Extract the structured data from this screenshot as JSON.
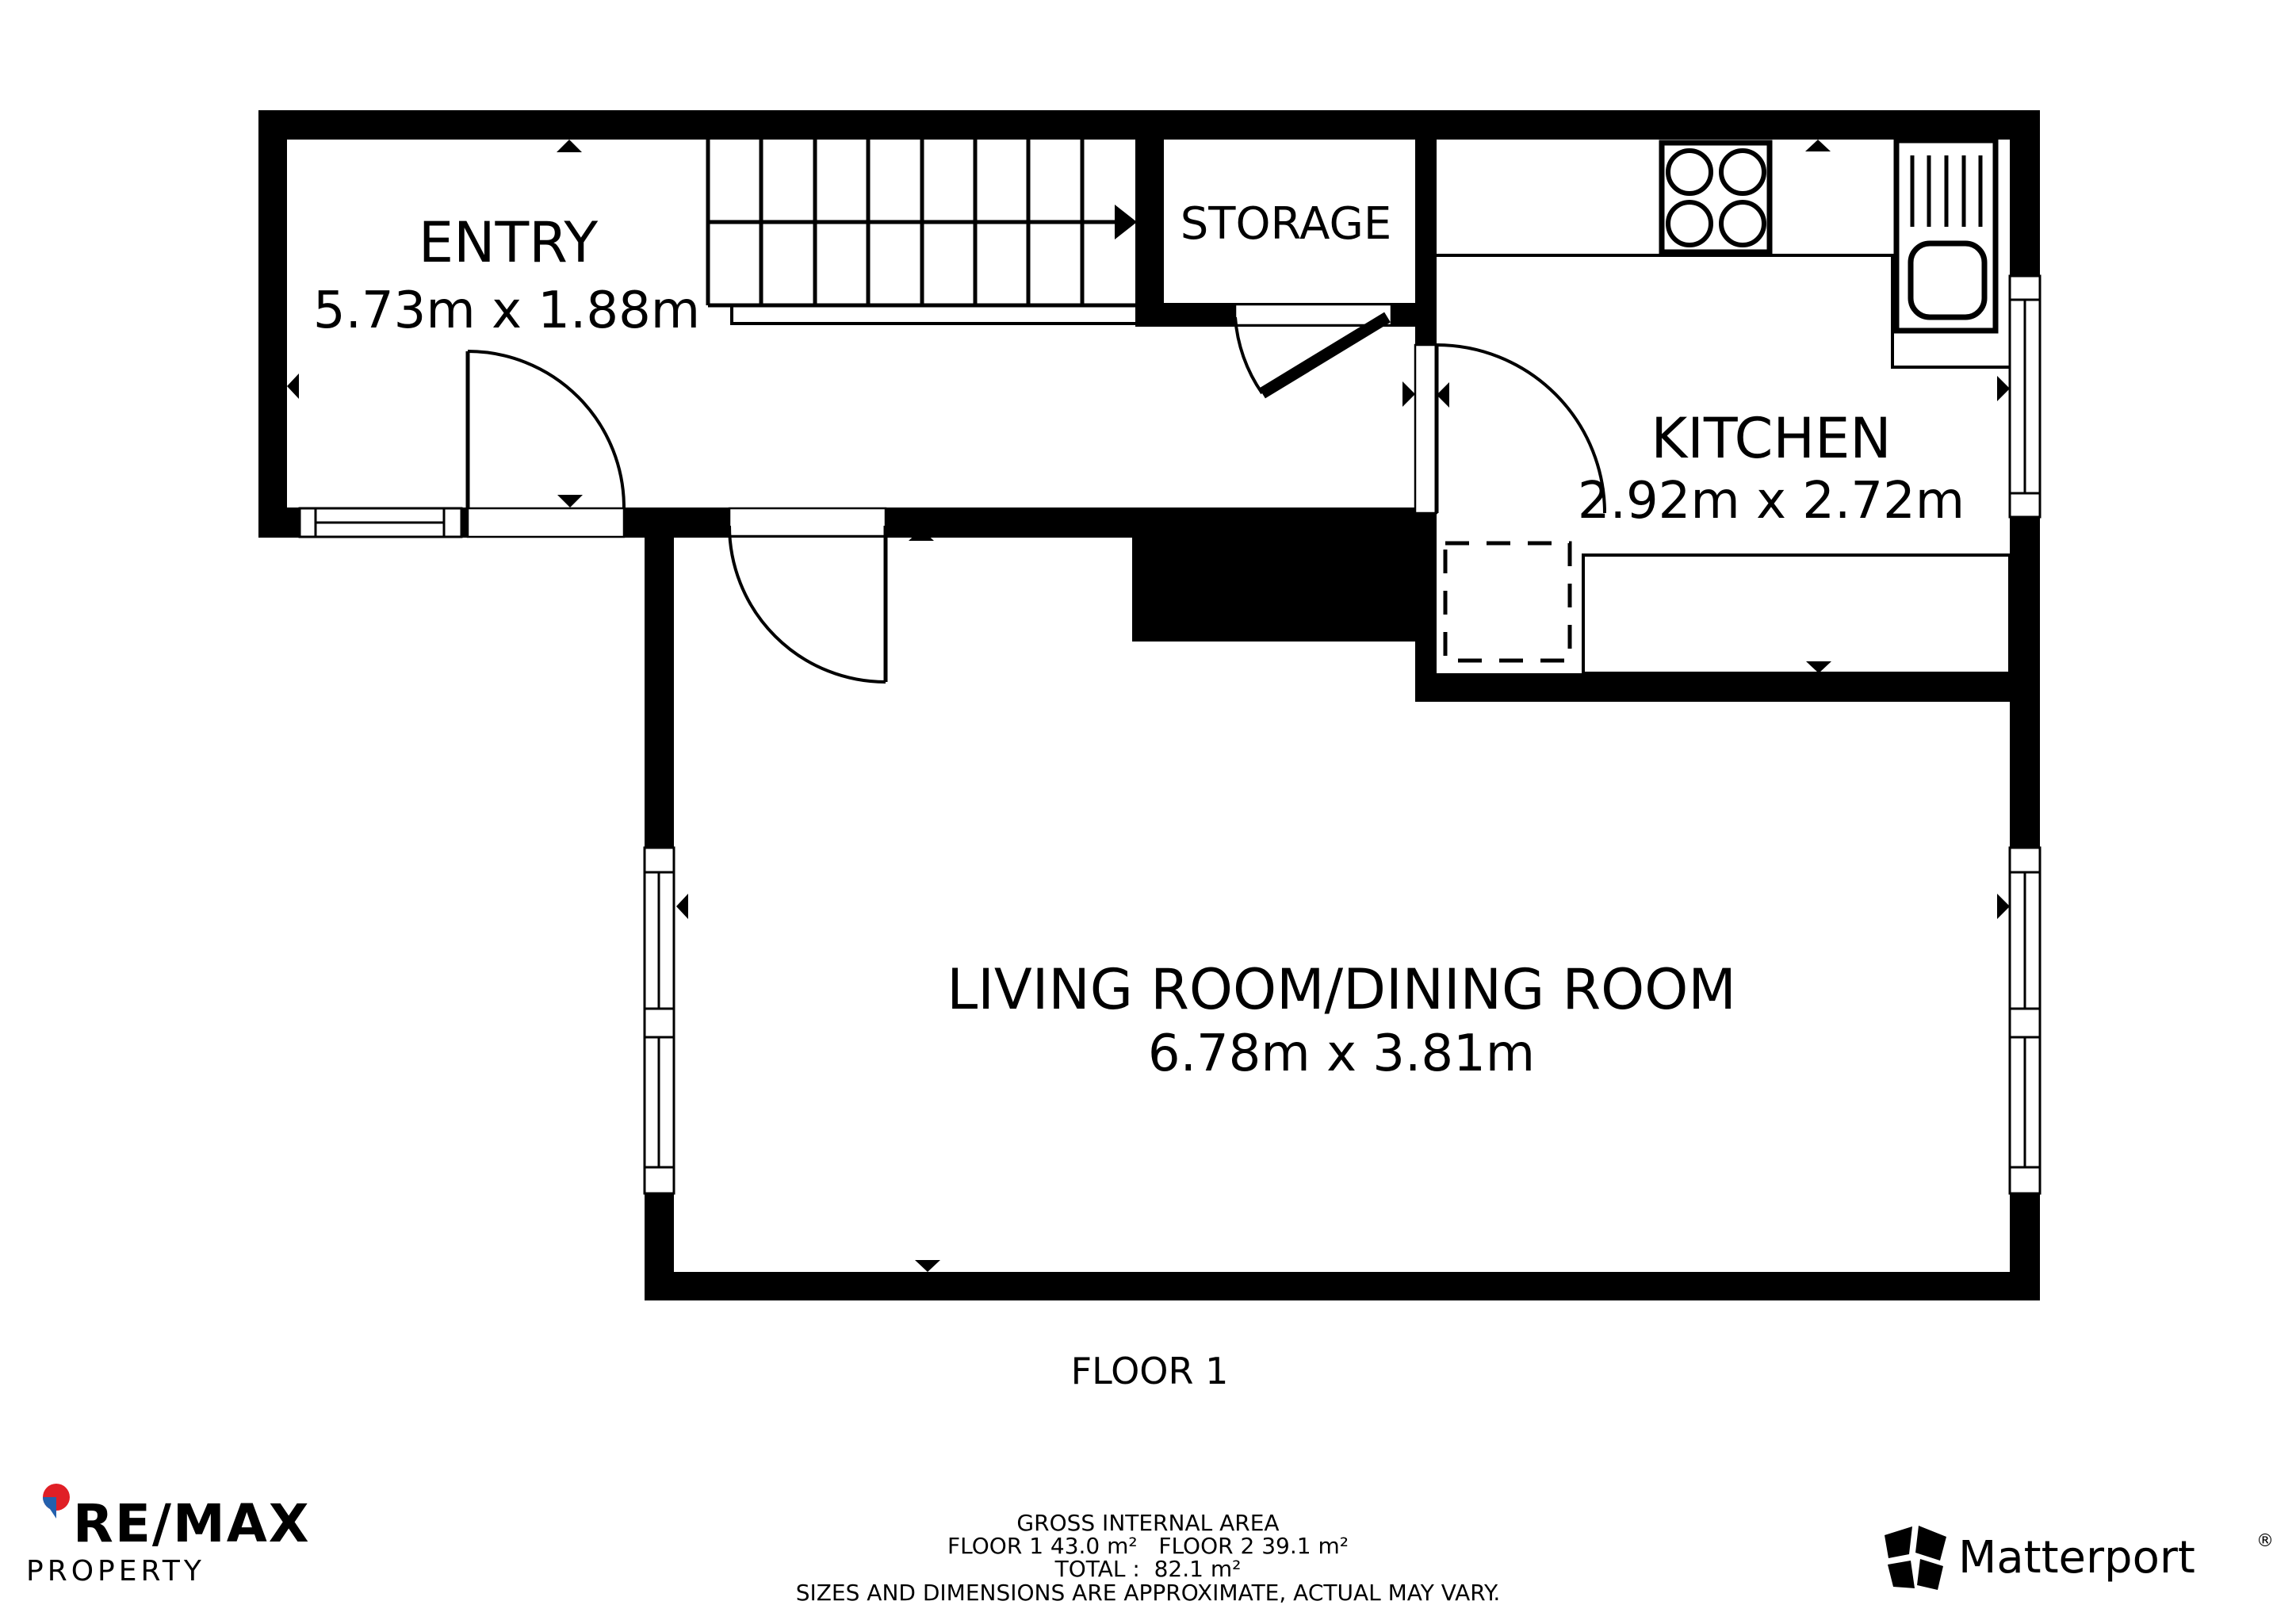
{
  "rooms": {
    "entry": {
      "name": "ENTRY",
      "dims": "5.73m x 1.88m"
    },
    "storage": {
      "name": "STORAGE"
    },
    "kitchen": {
      "name": "KITCHEN",
      "dims": "2.92m x 2.72m"
    },
    "living": {
      "name": "LIVING ROOM/DINING ROOM",
      "dims": "6.78m x 3.81m"
    }
  },
  "floor_label": "FLOOR 1",
  "footer": {
    "gross_internal_area_title": "GROSS INTERNAL AREA",
    "floor_areas": "FLOOR 1 43.0 m²   FLOOR 2 39.1 m²",
    "total": "TOTAL :  82.1 m²",
    "disclaimer": "SIZES AND DIMENSIONS ARE APPROXIMATE, ACTUAL MAY VARY."
  },
  "branding": {
    "remax": {
      "name": "RE/MAX",
      "sub": "PROPERTY"
    },
    "matterport": {
      "name": "Matterport",
      "reg": "®"
    }
  },
  "colors": {
    "wall": "#000000",
    "background": "#ffffff",
    "remax_red": "#e01f26",
    "remax_blue": "#2460ad",
    "remax_text": "#15152e",
    "property_blue": "#2a66b8"
  }
}
